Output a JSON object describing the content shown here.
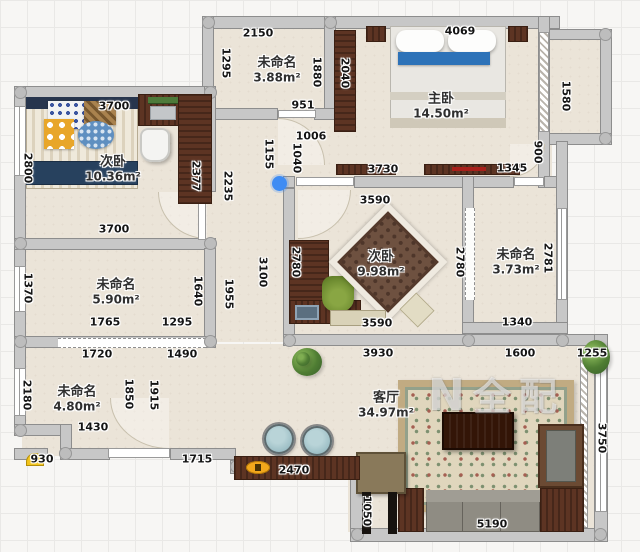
{
  "watermark": {
    "logo": "N",
    "text": "全配"
  },
  "rooms": [
    {
      "name": "未命名",
      "area": "3.88m²"
    },
    {
      "name": "主卧",
      "area": "14.50m²"
    },
    {
      "name": "次卧",
      "area": "10.36m²"
    },
    {
      "name": "次卧",
      "area": "9.98m²"
    },
    {
      "name": "未命名",
      "area": "3.73m²"
    },
    {
      "name": "未命名",
      "area": "5.90m²"
    },
    {
      "name": "未命名",
      "area": "4.80m²"
    },
    {
      "name": "客厅",
      "area": "34.97m²"
    }
  ],
  "dims": [
    "2150",
    "1295",
    "1880",
    "951",
    "1006",
    "1040",
    "1155",
    "4069",
    "2040",
    "1580",
    "900",
    "1345",
    "3730",
    "3700",
    "2800",
    "2377",
    "2235",
    "3700",
    "3100",
    "3590",
    "2780",
    "2780",
    "3590",
    "2781",
    "1340",
    "1370",
    "1640",
    "1955",
    "1765",
    "1295",
    "1720",
    "1490",
    "1850",
    "1915",
    "2180",
    "1430",
    "930",
    "1715",
    "2470",
    "3930",
    "1600",
    "1255",
    "3750",
    "1050",
    "5190"
  ]
}
